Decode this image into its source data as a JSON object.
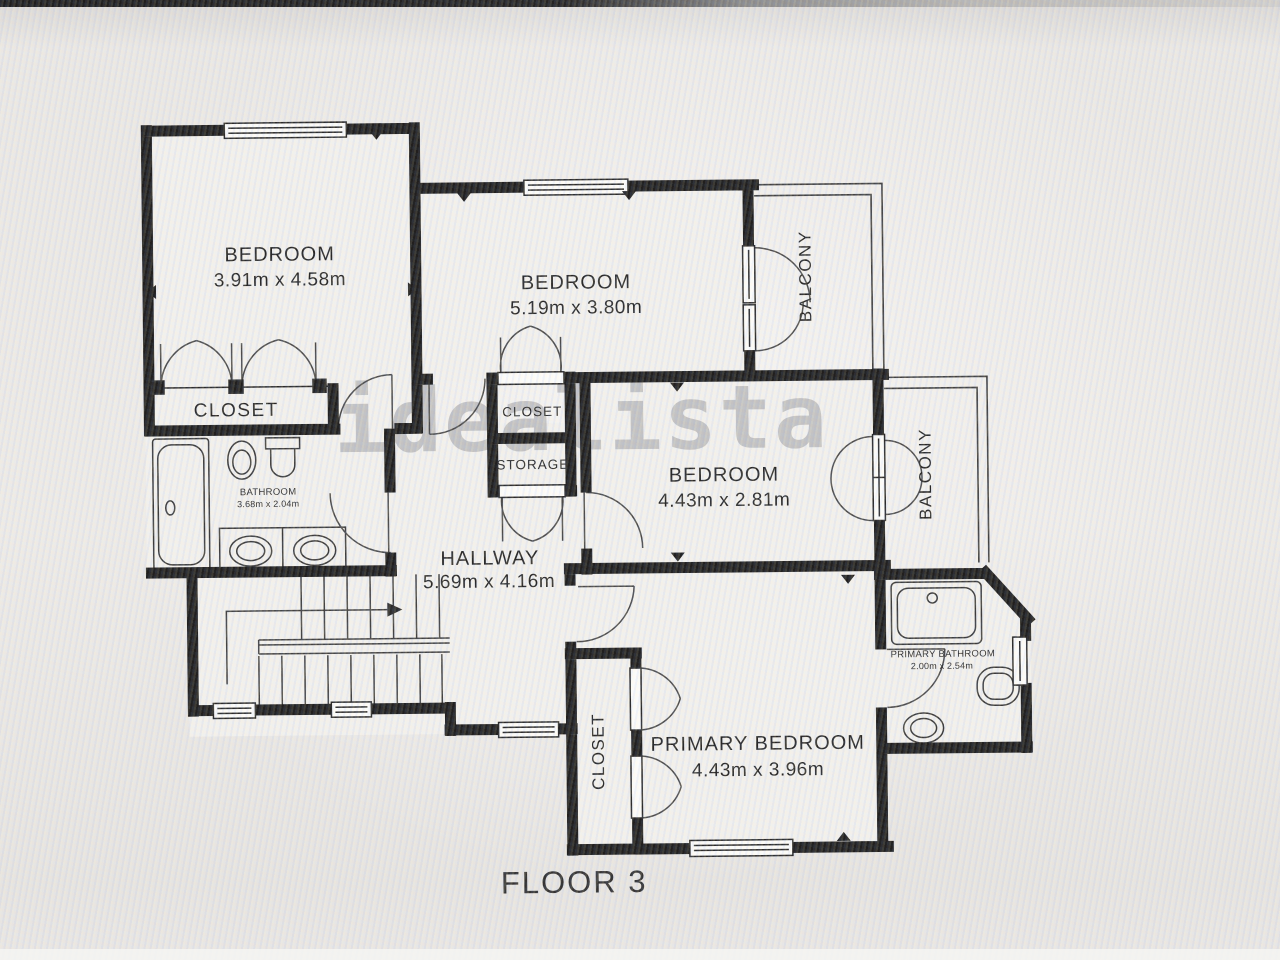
{
  "watermark": "idealista",
  "floor_label": "FLOOR 3",
  "rooms": {
    "bedroom1": {
      "name": "BEDROOM",
      "dims": "3.91m x 4.58m"
    },
    "bedroom2": {
      "name": "BEDROOM",
      "dims": "5.19m x 3.80m"
    },
    "bedroom3": {
      "name": "BEDROOM",
      "dims": "4.43m x 2.81m"
    },
    "primary_bedroom": {
      "name": "PRIMARY BEDROOM",
      "dims": "4.43m x 3.96m"
    },
    "hallway": {
      "name": "HALLWAY",
      "dims": "5.69m x 4.16m"
    },
    "bathroom": {
      "name": "BATHROOM",
      "dims": "3.68m x 2.04m"
    },
    "primary_bathroom": {
      "name": "PRIMARY BATHROOM",
      "dims": "2.00m x 2.54m"
    }
  },
  "labels": {
    "closet_main": "CLOSET",
    "closet_small": "CLOSET",
    "storage": "STORAGE",
    "closet_primary": "CLOSET",
    "balcony_top": "BALCONY",
    "balcony_right": "BALCONY"
  },
  "colors": {
    "wall": "#161616",
    "floor": "#f2f1ee",
    "thin_line": "#2a2a2a",
    "text": "#1e1e1e",
    "watermark_gray": "#8e8e93",
    "background": "#eae8e5"
  }
}
